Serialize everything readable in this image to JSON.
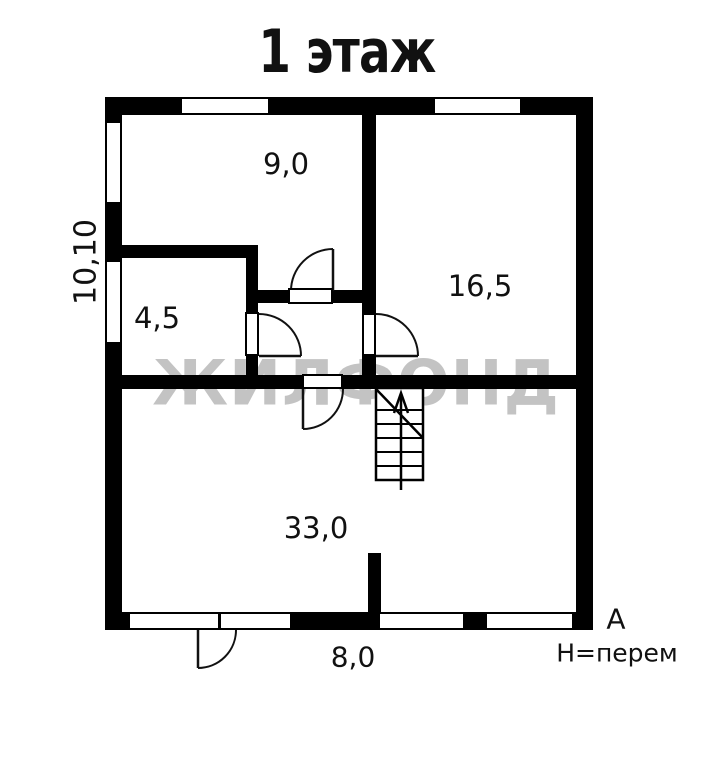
{
  "title": "1 этаж",
  "watermark": "ЖИЛФОНД",
  "rooms": [
    {
      "name": "room-9",
      "area": "9,0"
    },
    {
      "name": "room-4-5",
      "area": "4,5"
    },
    {
      "name": "room-16-5",
      "area": "16,5"
    },
    {
      "name": "room-33",
      "area": "33,0"
    }
  ],
  "dimensions": {
    "overall_height_left": "10,10",
    "overall_width_bottom": "8,0"
  },
  "annotations": {
    "axis": "А",
    "height_note": "Н=перем"
  },
  "colors": {
    "wall": "#000000",
    "background": "#ffffff",
    "watermark": "#b9b9b9",
    "line": "#111111"
  }
}
